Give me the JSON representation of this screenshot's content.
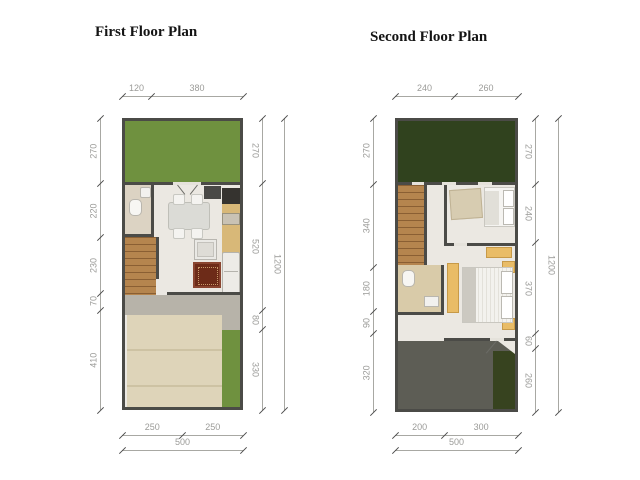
{
  "plans": [
    {
      "title": "First Floor Plan",
      "dims": {
        "top": [
          "120",
          "380"
        ],
        "left": [
          "270",
          "220",
          "230",
          "70",
          "410"
        ],
        "right": [
          "270",
          "520",
          "80",
          "330"
        ],
        "right_total": "1200",
        "bottom": [
          "250",
          "250"
        ],
        "bottom_total": "500"
      }
    },
    {
      "title": "Second Floor Plan",
      "dims": {
        "top": [
          "240",
          "260"
        ],
        "left": [
          "270",
          "340",
          "180",
          "90",
          "320"
        ],
        "right": [
          "270",
          "240",
          "370",
          "60",
          "260"
        ],
        "right_total": "1200",
        "bottom": [
          "200",
          "300"
        ],
        "bottom_total": "500"
      }
    }
  ],
  "colors": {
    "wall": "#4b4b47",
    "floor": "#ebe8e2",
    "garden_first_floor": "#6f913f",
    "roof_garden_second_floor": "#30421e",
    "stairs_wood": "#b5854e",
    "carport": "#ded4b9",
    "terrace_gray": "#b7b3a9",
    "roof_gray": "#5d5d55",
    "roof_green_strip": "#37431f",
    "kitchen_counter": "#d8b878",
    "rug": "#6d2b18",
    "furniture_yellow": "#e9bc66",
    "dimension_text": "#9b9b98"
  }
}
